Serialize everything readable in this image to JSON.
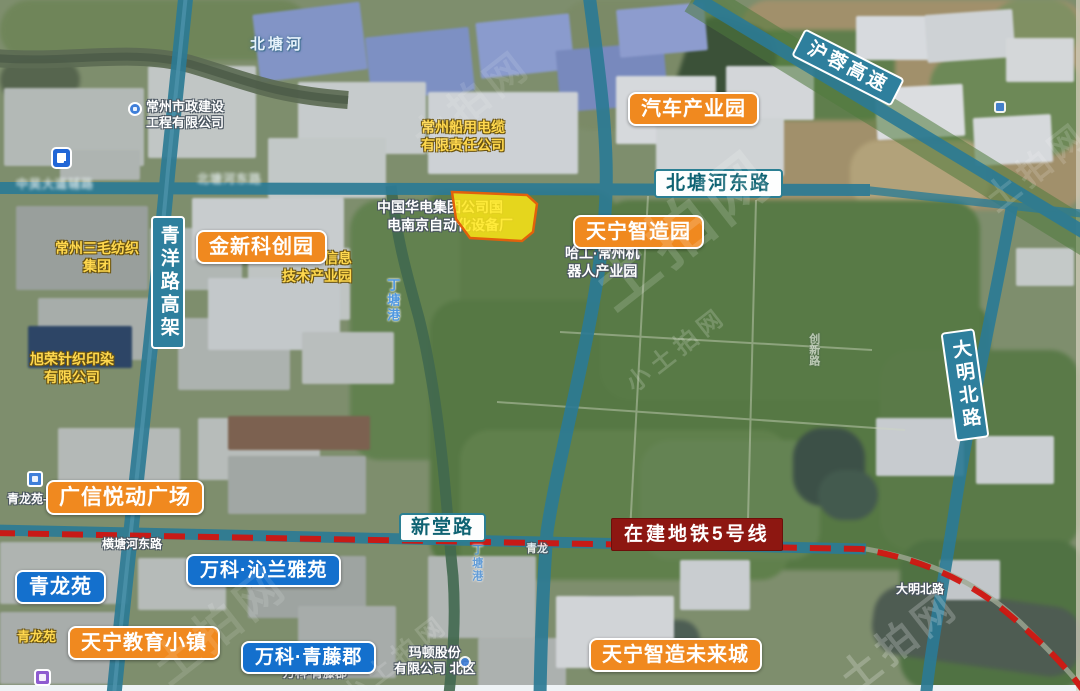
{
  "labels": {
    "orange": [
      "汽车产业园",
      "金新科创园",
      "天宁智造园",
      "广信悦动广场",
      "天宁教育小镇",
      "天宁智造未来城"
    ],
    "blue": [
      "青龙苑",
      "万科·沁兰雅苑",
      "万科·青藤郡"
    ],
    "road_white": [
      "北塘河东路",
      "新堂路"
    ],
    "road_vertical": [
      "青洋路高架",
      "大明北路"
    ],
    "highway": "沪蓉高速",
    "metro": "在建地铁5号线"
  },
  "map_texts": {
    "yellow": [
      {
        "line1": "常州船用电缆",
        "line2": "有限责任公司"
      },
      {
        "line1": "常州三毛纺织",
        "line2": "集团"
      },
      {
        "line1": "信息",
        "line2": "技术产业园"
      },
      {
        "line1": "旭荣针织印染",
        "line2": "有限公司"
      },
      {
        "line1": "青龙苑",
        "line2": ""
      }
    ],
    "white": [
      {
        "line1": "常州市政建设",
        "line2": "工程有限公司"
      },
      {
        "line1": "中国华电集团公司国",
        "line2": "电南京自动化设备厂"
      },
      {
        "line1": "哈工·常州机",
        "line2": "器人产业园"
      },
      {
        "line1": "玛顿股份",
        "line2": "有限公司 北区"
      },
      {
        "line1": "青龙苑-",
        "line2": ""
      },
      {
        "line1": "横塘河东路",
        "line2": ""
      },
      {
        "line1": "青龙",
        "line2": ""
      },
      {
        "line1": "万科·青藤郡",
        "line2": ""
      },
      {
        "line1": "大明北路",
        "line2": ""
      }
    ],
    "rivers": [
      "北塘河",
      "丁塘港"
    ],
    "blurry": [
      "中吴大道辅路",
      "北塘河东路"
    ],
    "faint_vertical": "创新路"
  },
  "parcel": {
    "name": "出让地块",
    "fill": "#ffe714",
    "stroke": "#e2610b"
  },
  "colors": {
    "road": "#2c7b95",
    "metro_dash": "#d01510",
    "label_orange": "#f0891f",
    "label_blue": "#1470cd",
    "metro_label_bg": "#8d1711"
  },
  "watermark": {
    "text": "土拍网",
    "text_small": "小土拍网"
  }
}
